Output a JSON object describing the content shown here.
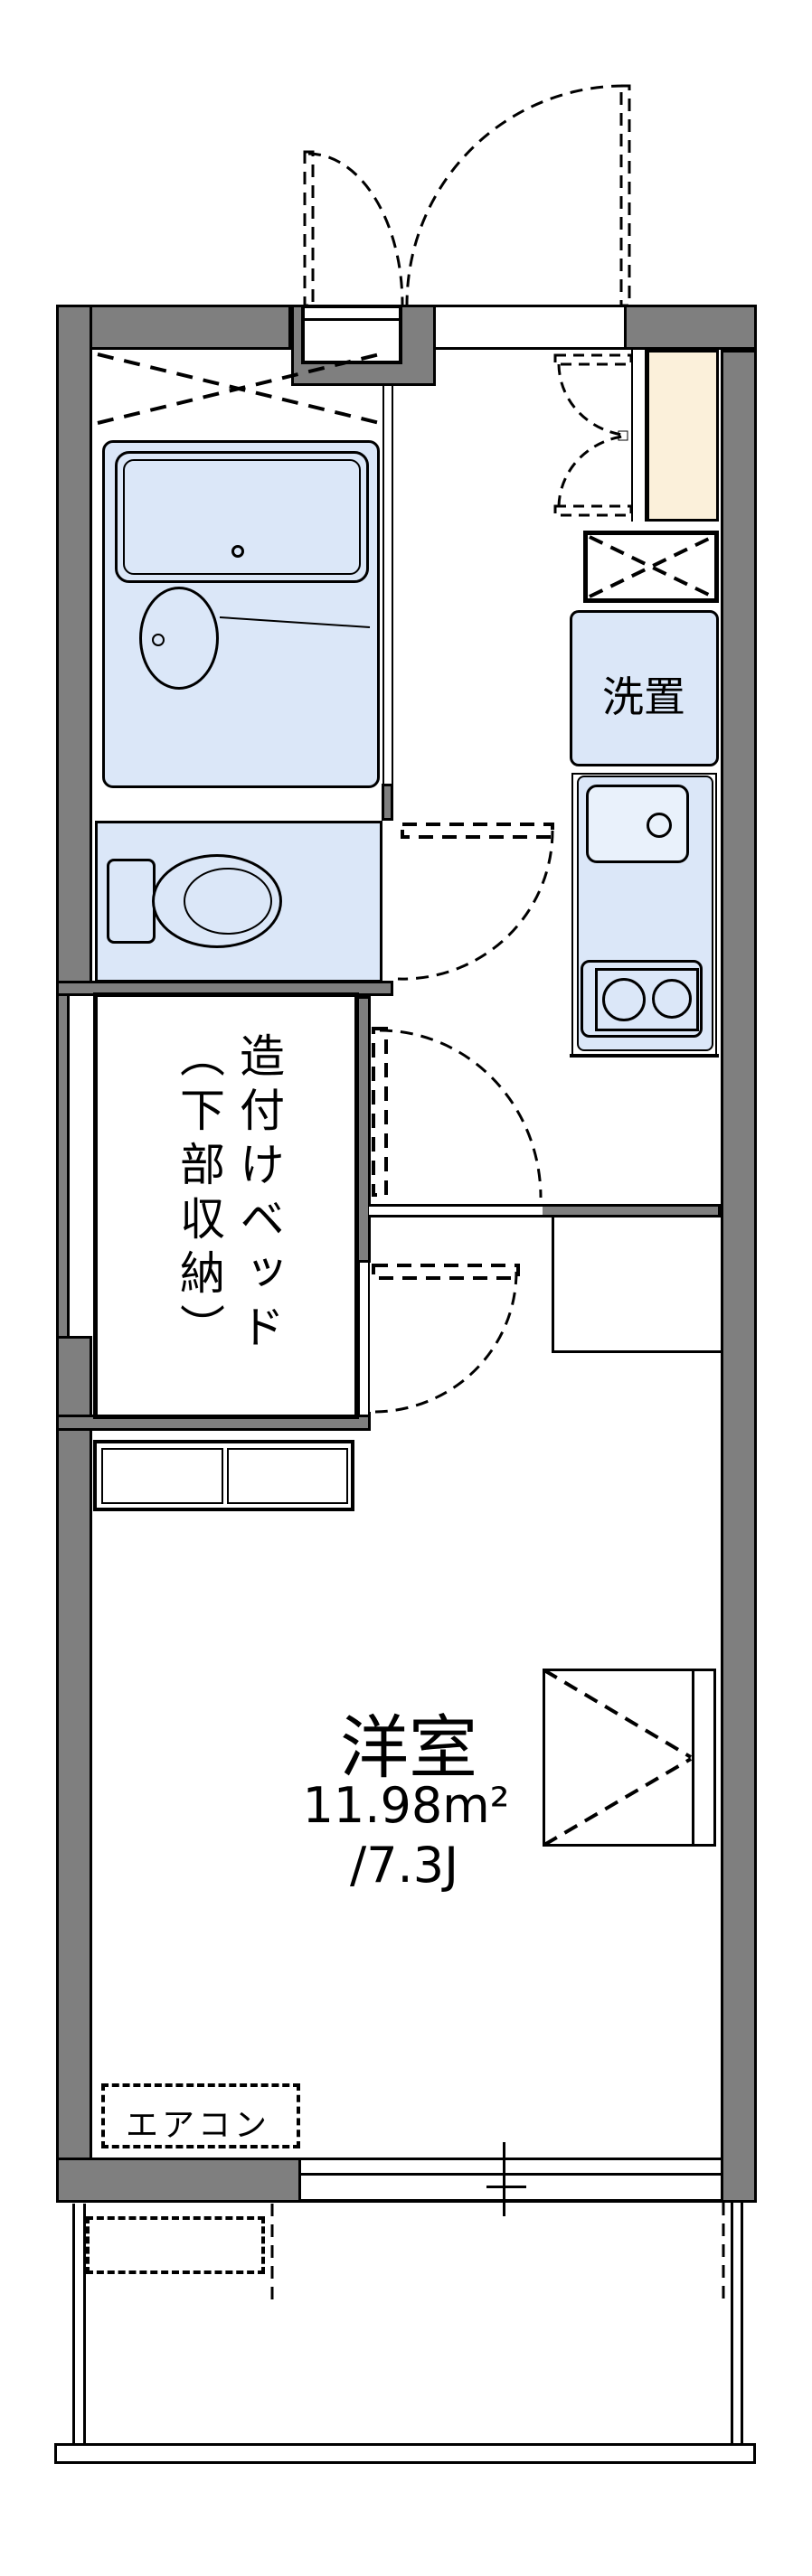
{
  "floorplan": {
    "rooms": {
      "laundry_label": "洗置",
      "bed_label_line1": "造付けベッド",
      "bed_label_line2": "（下部収納）",
      "main_room_name": "洋室",
      "main_room_area_sqm": "11.98m²",
      "main_room_area_tatami": "/7.3J",
      "aircon_label": "エアコン"
    },
    "colors": {
      "wall": "#7f7f7f",
      "fixture": "#dbe7f8",
      "closet": "#fbf0da",
      "line": "#000000",
      "background": "#ffffff"
    }
  }
}
